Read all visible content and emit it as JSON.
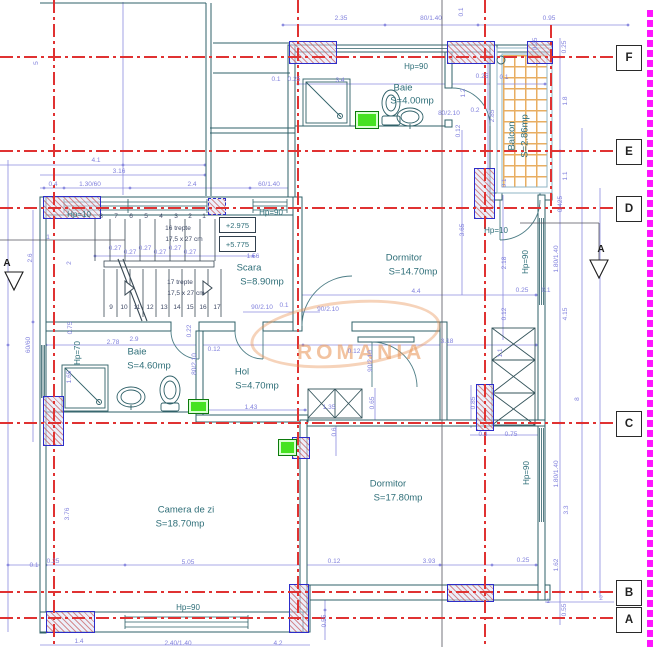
{
  "watermark": {
    "text": "ROMANIA"
  },
  "grid_bubbles": [
    "F",
    "E",
    "D",
    "C",
    "B",
    "A"
  ],
  "levels": {
    "lower": "+2.975",
    "upper": "+5.775"
  },
  "rooms": [
    {
      "name": "Scara",
      "area": "S=8.90mp"
    },
    {
      "name": "Dormitor",
      "area": "S=14.70mp"
    },
    {
      "name": "Baie",
      "area": "S=4.00mp"
    },
    {
      "name": "Balcon",
      "area": "S=2.86mp"
    },
    {
      "name": "Baie",
      "area": "S=4.60mp"
    },
    {
      "name": "Hol",
      "area": "S=4.70mp"
    },
    {
      "name": "Dormitor",
      "area": "S=17.80mp"
    },
    {
      "name": "Camera de zi",
      "area": "S=18.70mp"
    }
  ],
  "stairs": {
    "run1": "16 trepte",
    "run2": "17 trepte",
    "tread": "17,5 x 27 cm"
  },
  "labels": [
    {
      "t": "2.35",
      "x": 341,
      "y": 19,
      "c": "d"
    },
    {
      "t": "80/1.40",
      "x": 431,
      "y": 19,
      "c": "d"
    },
    {
      "t": "0.95",
      "x": 549,
      "y": 19,
      "c": "d"
    },
    {
      "t": "5",
      "x": 37,
      "y": 63,
      "c": "d",
      "r": 1
    },
    {
      "t": "0.1",
      "x": 462,
      "y": 12,
      "c": "d",
      "r": 1
    },
    {
      "t": "0.25",
      "x": 536,
      "y": 44,
      "c": "d",
      "r": 1
    },
    {
      "t": "0.25",
      "x": 565,
      "y": 47,
      "c": "d",
      "r": 1
    },
    {
      "t": "0.1",
      "x": 276,
      "y": 80,
      "c": "d"
    },
    {
      "t": "0.25",
      "x": 294,
      "y": 80,
      "c": "d"
    },
    {
      "t": "0.25",
      "x": 482,
      "y": 77,
      "c": "d"
    },
    {
      "t": "0.1",
      "x": 504,
      "y": 78,
      "c": "d"
    },
    {
      "t": "3.4",
      "x": 340,
      "y": 81,
      "c": "d"
    },
    {
      "t": "1.2",
      "x": 464,
      "y": 93,
      "c": "d",
      "r": 1
    },
    {
      "t": "0.2",
      "x": 475,
      "y": 111,
      "c": "d"
    },
    {
      "t": "80/2.10",
      "x": 449,
      "y": 114,
      "c": "d"
    },
    {
      "t": "0.12",
      "x": 459,
      "y": 131,
      "c": "d",
      "r": 1
    },
    {
      "t": "2.85",
      "x": 493,
      "y": 116,
      "c": "d",
      "r": 1
    },
    {
      "t": "1.8",
      "x": 566,
      "y": 101,
      "c": "d",
      "r": 1
    },
    {
      "t": "1.1",
      "x": 566,
      "y": 176,
      "c": "d",
      "r": 1
    },
    {
      "t": "0.425",
      "x": 561,
      "y": 204,
      "c": "d",
      "r": 1
    },
    {
      "t": "0.1",
      "x": 505,
      "y": 183,
      "c": "d",
      "r": 1
    },
    {
      "t": "4.1",
      "x": 96,
      "y": 161,
      "c": "d"
    },
    {
      "t": "3.16",
      "x": 119,
      "y": 172,
      "c": "d"
    },
    {
      "t": "0.4",
      "x": 53,
      "y": 185,
      "c": "d"
    },
    {
      "t": "1.30/60",
      "x": 90,
      "y": 185,
      "c": "d"
    },
    {
      "t": "2.4",
      "x": 192,
      "y": 185,
      "c": "d"
    },
    {
      "t": "60/1.40",
      "x": 269,
      "y": 185,
      "c": "d"
    },
    {
      "t": "1",
      "x": 48,
      "y": 238,
      "c": "d"
    },
    {
      "t": "2.6",
      "x": 31,
      "y": 258,
      "c": "d",
      "r": 1
    },
    {
      "t": "2",
      "x": 70,
      "y": 263,
      "c": "d",
      "r": 1
    },
    {
      "t": "60/60",
      "x": 29,
      "y": 345,
      "c": "d",
      "r": 1
    },
    {
      "t": "0.75",
      "x": 71,
      "y": 328,
      "c": "d",
      "r": 1
    },
    {
      "t": "1.65",
      "x": 70,
      "y": 377,
      "c": "d",
      "r": 1
    },
    {
      "t": "1.56",
      "x": 253,
      "y": 257,
      "c": "d"
    },
    {
      "t": "0.27",
      "x": 115,
      "y": 249,
      "c": "d"
    },
    {
      "t": "0.27",
      "x": 130,
      "y": 253,
      "c": "d"
    },
    {
      "t": "0.27",
      "x": 145,
      "y": 249,
      "c": "d"
    },
    {
      "t": "0.27",
      "x": 160,
      "y": 253,
      "c": "d"
    },
    {
      "t": "0.27",
      "x": 175,
      "y": 249,
      "c": "d"
    },
    {
      "t": "0.27",
      "x": 190,
      "y": 253,
      "c": "d"
    },
    {
      "t": "90/2.10",
      "x": 262,
      "y": 308,
      "c": "d"
    },
    {
      "t": "0.1",
      "x": 284,
      "y": 306,
      "c": "d"
    },
    {
      "t": "90/2.10",
      "x": 328,
      "y": 310,
      "c": "d"
    },
    {
      "t": "4.4",
      "x": 416,
      "y": 292,
      "c": "d"
    },
    {
      "t": "3.65",
      "x": 463,
      "y": 230,
      "c": "d",
      "r": 1
    },
    {
      "t": "2.18",
      "x": 505,
      "y": 263,
      "c": "d",
      "r": 1
    },
    {
      "t": "0.25",
      "x": 522,
      "y": 291,
      "c": "d"
    },
    {
      "t": "0.1",
      "x": 546,
      "y": 291,
      "c": "d"
    },
    {
      "t": "0.12",
      "x": 505,
      "y": 314,
      "c": "d",
      "r": 1
    },
    {
      "t": "1.80/1.40",
      "x": 557,
      "y": 259,
      "c": "d",
      "r": 1
    },
    {
      "t": "4.15",
      "x": 566,
      "y": 314,
      "c": "d",
      "r": 1
    },
    {
      "t": "2.9",
      "x": 134,
      "y": 340,
      "c": "d"
    },
    {
      "t": "0.22",
      "x": 190,
      "y": 331,
      "c": "d",
      "r": 1
    },
    {
      "t": "0.12",
      "x": 214,
      "y": 350,
      "c": "d"
    },
    {
      "t": "2.78",
      "x": 113,
      "y": 343,
      "c": "d"
    },
    {
      "t": "80/2.10",
      "x": 195,
      "y": 364,
      "c": "d",
      "r": 1
    },
    {
      "t": "1.43",
      "x": 251,
      "y": 408,
      "c": "d"
    },
    {
      "t": "0.12",
      "x": 354,
      "y": 352,
      "c": "d"
    },
    {
      "t": "3.18",
      "x": 447,
      "y": 342,
      "c": "d"
    },
    {
      "t": "90/2.10",
      "x": 371,
      "y": 361,
      "c": "d",
      "r": 1
    },
    {
      "t": "1.1",
      "x": 501,
      "y": 353,
      "c": "d",
      "r": 1
    },
    {
      "t": "0.65",
      "x": 373,
      "y": 403,
      "c": "d",
      "r": 1
    },
    {
      "t": "0.85",
      "x": 474,
      "y": 403,
      "c": "d",
      "r": 1
    },
    {
      "t": "1.35",
      "x": 329,
      "y": 408,
      "c": "d"
    },
    {
      "t": "0.6",
      "x": 335,
      "y": 432,
      "c": "d",
      "r": 1
    },
    {
      "t": "0.3",
      "x": 483,
      "y": 435,
      "c": "d"
    },
    {
      "t": "0.75",
      "x": 511,
      "y": 435,
      "c": "d"
    },
    {
      "t": "8",
      "x": 578,
      "y": 399,
      "c": "d",
      "r": 1
    },
    {
      "t": "1.80/1.40",
      "x": 557,
      "y": 474,
      "c": "d",
      "r": 1
    },
    {
      "t": "3.3",
      "x": 567,
      "y": 510,
      "c": "d",
      "r": 1
    },
    {
      "t": "1.62",
      "x": 557,
      "y": 565,
      "c": "d",
      "r": 1
    },
    {
      "t": "0.55",
      "x": 565,
      "y": 610,
      "c": "d",
      "r": 1
    },
    {
      "t": "2",
      "x": 601,
      "y": 599,
      "c": "d"
    },
    {
      "t": "1",
      "x": 548,
      "y": 602,
      "c": "d"
    },
    {
      "t": "3.76",
      "x": 68,
      "y": 514,
      "c": "d",
      "r": 1
    },
    {
      "t": "5.05",
      "x": 188,
      "y": 563,
      "c": "d"
    },
    {
      "t": "0.1",
      "x": 34,
      "y": 566,
      "c": "d"
    },
    {
      "t": "0.25",
      "x": 53,
      "y": 562,
      "c": "d"
    },
    {
      "t": "0.12",
      "x": 334,
      "y": 562,
      "c": "d"
    },
    {
      "t": "3.93",
      "x": 429,
      "y": 562,
      "c": "d"
    },
    {
      "t": "0.25",
      "x": 523,
      "y": 561,
      "c": "d"
    },
    {
      "t": "0.55",
      "x": 325,
      "y": 621,
      "c": "d",
      "r": 1
    },
    {
      "t": "1.4",
      "x": 79,
      "y": 642,
      "c": "d"
    },
    {
      "t": "2.40/1.40",
      "x": 178,
      "y": 644,
      "c": "d"
    },
    {
      "t": "4.2",
      "x": 278,
      "y": 644,
      "c": "d"
    },
    {
      "t": "Hp=10",
      "x": 79,
      "y": 215,
      "c": "h"
    },
    {
      "t": "Hp=90",
      "x": 271,
      "y": 213,
      "c": "h"
    },
    {
      "t": "Hp=90",
      "x": 416,
      "y": 67,
      "c": "h"
    },
    {
      "t": "Hp=10",
      "x": 496,
      "y": 231,
      "c": "h"
    },
    {
      "t": "Hp=90",
      "x": 526,
      "y": 262,
      "c": "h",
      "r": 1
    },
    {
      "t": "Hp=70",
      "x": 78,
      "y": 353,
      "c": "h",
      "r": 1
    },
    {
      "t": "Hp=90",
      "x": 527,
      "y": 473,
      "c": "h",
      "r": 1
    },
    {
      "t": "Hp=90",
      "x": 188,
      "y": 608,
      "c": "h"
    },
    {
      "t": "Scara",
      "x": 249,
      "y": 268,
      "c": "m"
    },
    {
      "t": "S=8.90mp",
      "x": 262,
      "y": 282,
      "c": "m"
    },
    {
      "t": "Dormitor",
      "x": 404,
      "y": 258,
      "c": "m"
    },
    {
      "t": "S=14.70mp",
      "x": 413,
      "y": 272,
      "c": "m"
    },
    {
      "t": "Baie",
      "x": 403,
      "y": 88,
      "c": "m"
    },
    {
      "t": "S=4.00mp",
      "x": 412,
      "y": 101,
      "c": "m"
    },
    {
      "t": "Balcon",
      "x": 512,
      "y": 136,
      "c": "m",
      "r": 1
    },
    {
      "t": "S=2.86mp",
      "x": 525,
      "y": 136,
      "c": "m",
      "r": 1
    },
    {
      "t": "Baie",
      "x": 137,
      "y": 352,
      "c": "m"
    },
    {
      "t": "S=4.60mp",
      "x": 149,
      "y": 366,
      "c": "m"
    },
    {
      "t": "Hol",
      "x": 242,
      "y": 372,
      "c": "m"
    },
    {
      "t": "S=4.70mp",
      "x": 257,
      "y": 386,
      "c": "m"
    },
    {
      "t": "Dormitor",
      "x": 388,
      "y": 484,
      "c": "m"
    },
    {
      "t": "S=17.80mp",
      "x": 398,
      "y": 498,
      "c": "m"
    },
    {
      "t": "Camera de zi",
      "x": 186,
      "y": 510,
      "c": "m"
    },
    {
      "t": "S=18.70mp",
      "x": 180,
      "y": 524,
      "c": "m"
    },
    {
      "t": "16 trepte",
      "x": 178,
      "y": 229,
      "c": "k"
    },
    {
      "t": "17,5 x 27 cm",
      "x": 184,
      "y": 240,
      "c": "k"
    },
    {
      "t": "17 trepte",
      "x": 180,
      "y": 283,
      "c": "k"
    },
    {
      "t": "17,5 x 27 cm",
      "x": 186,
      "y": 294,
      "c": "k"
    },
    {
      "t": "8",
      "x": 101,
      "y": 217,
      "c": "n"
    },
    {
      "t": "7",
      "x": 116,
      "y": 217,
      "c": "n"
    },
    {
      "t": "6",
      "x": 131,
      "y": 217,
      "c": "n"
    },
    {
      "t": "5",
      "x": 146,
      "y": 217,
      "c": "n"
    },
    {
      "t": "4",
      "x": 161,
      "y": 217,
      "c": "n"
    },
    {
      "t": "3",
      "x": 176,
      "y": 217,
      "c": "n"
    },
    {
      "t": "2",
      "x": 190,
      "y": 217,
      "c": "n"
    },
    {
      "t": "1",
      "x": 204,
      "y": 217,
      "c": "n"
    },
    {
      "t": "9",
      "x": 111,
      "y": 308,
      "c": "n"
    },
    {
      "t": "10",
      "x": 124,
      "y": 308,
      "c": "n"
    },
    {
      "t": "11",
      "x": 137,
      "y": 308,
      "c": "n"
    },
    {
      "t": "12",
      "x": 150,
      "y": 308,
      "c": "n"
    },
    {
      "t": "13",
      "x": 164,
      "y": 308,
      "c": "n"
    },
    {
      "t": "14",
      "x": 177,
      "y": 308,
      "c": "n"
    },
    {
      "t": "15",
      "x": 190,
      "y": 308,
      "c": "n"
    },
    {
      "t": "16",
      "x": 203,
      "y": 308,
      "c": "n"
    },
    {
      "t": "17",
      "x": 217,
      "y": 308,
      "c": "n"
    },
    {
      "t": "A",
      "x": 7,
      "y": 264,
      "c": "s"
    },
    {
      "t": "A",
      "x": 601,
      "y": 250,
      "c": "s"
    }
  ]
}
